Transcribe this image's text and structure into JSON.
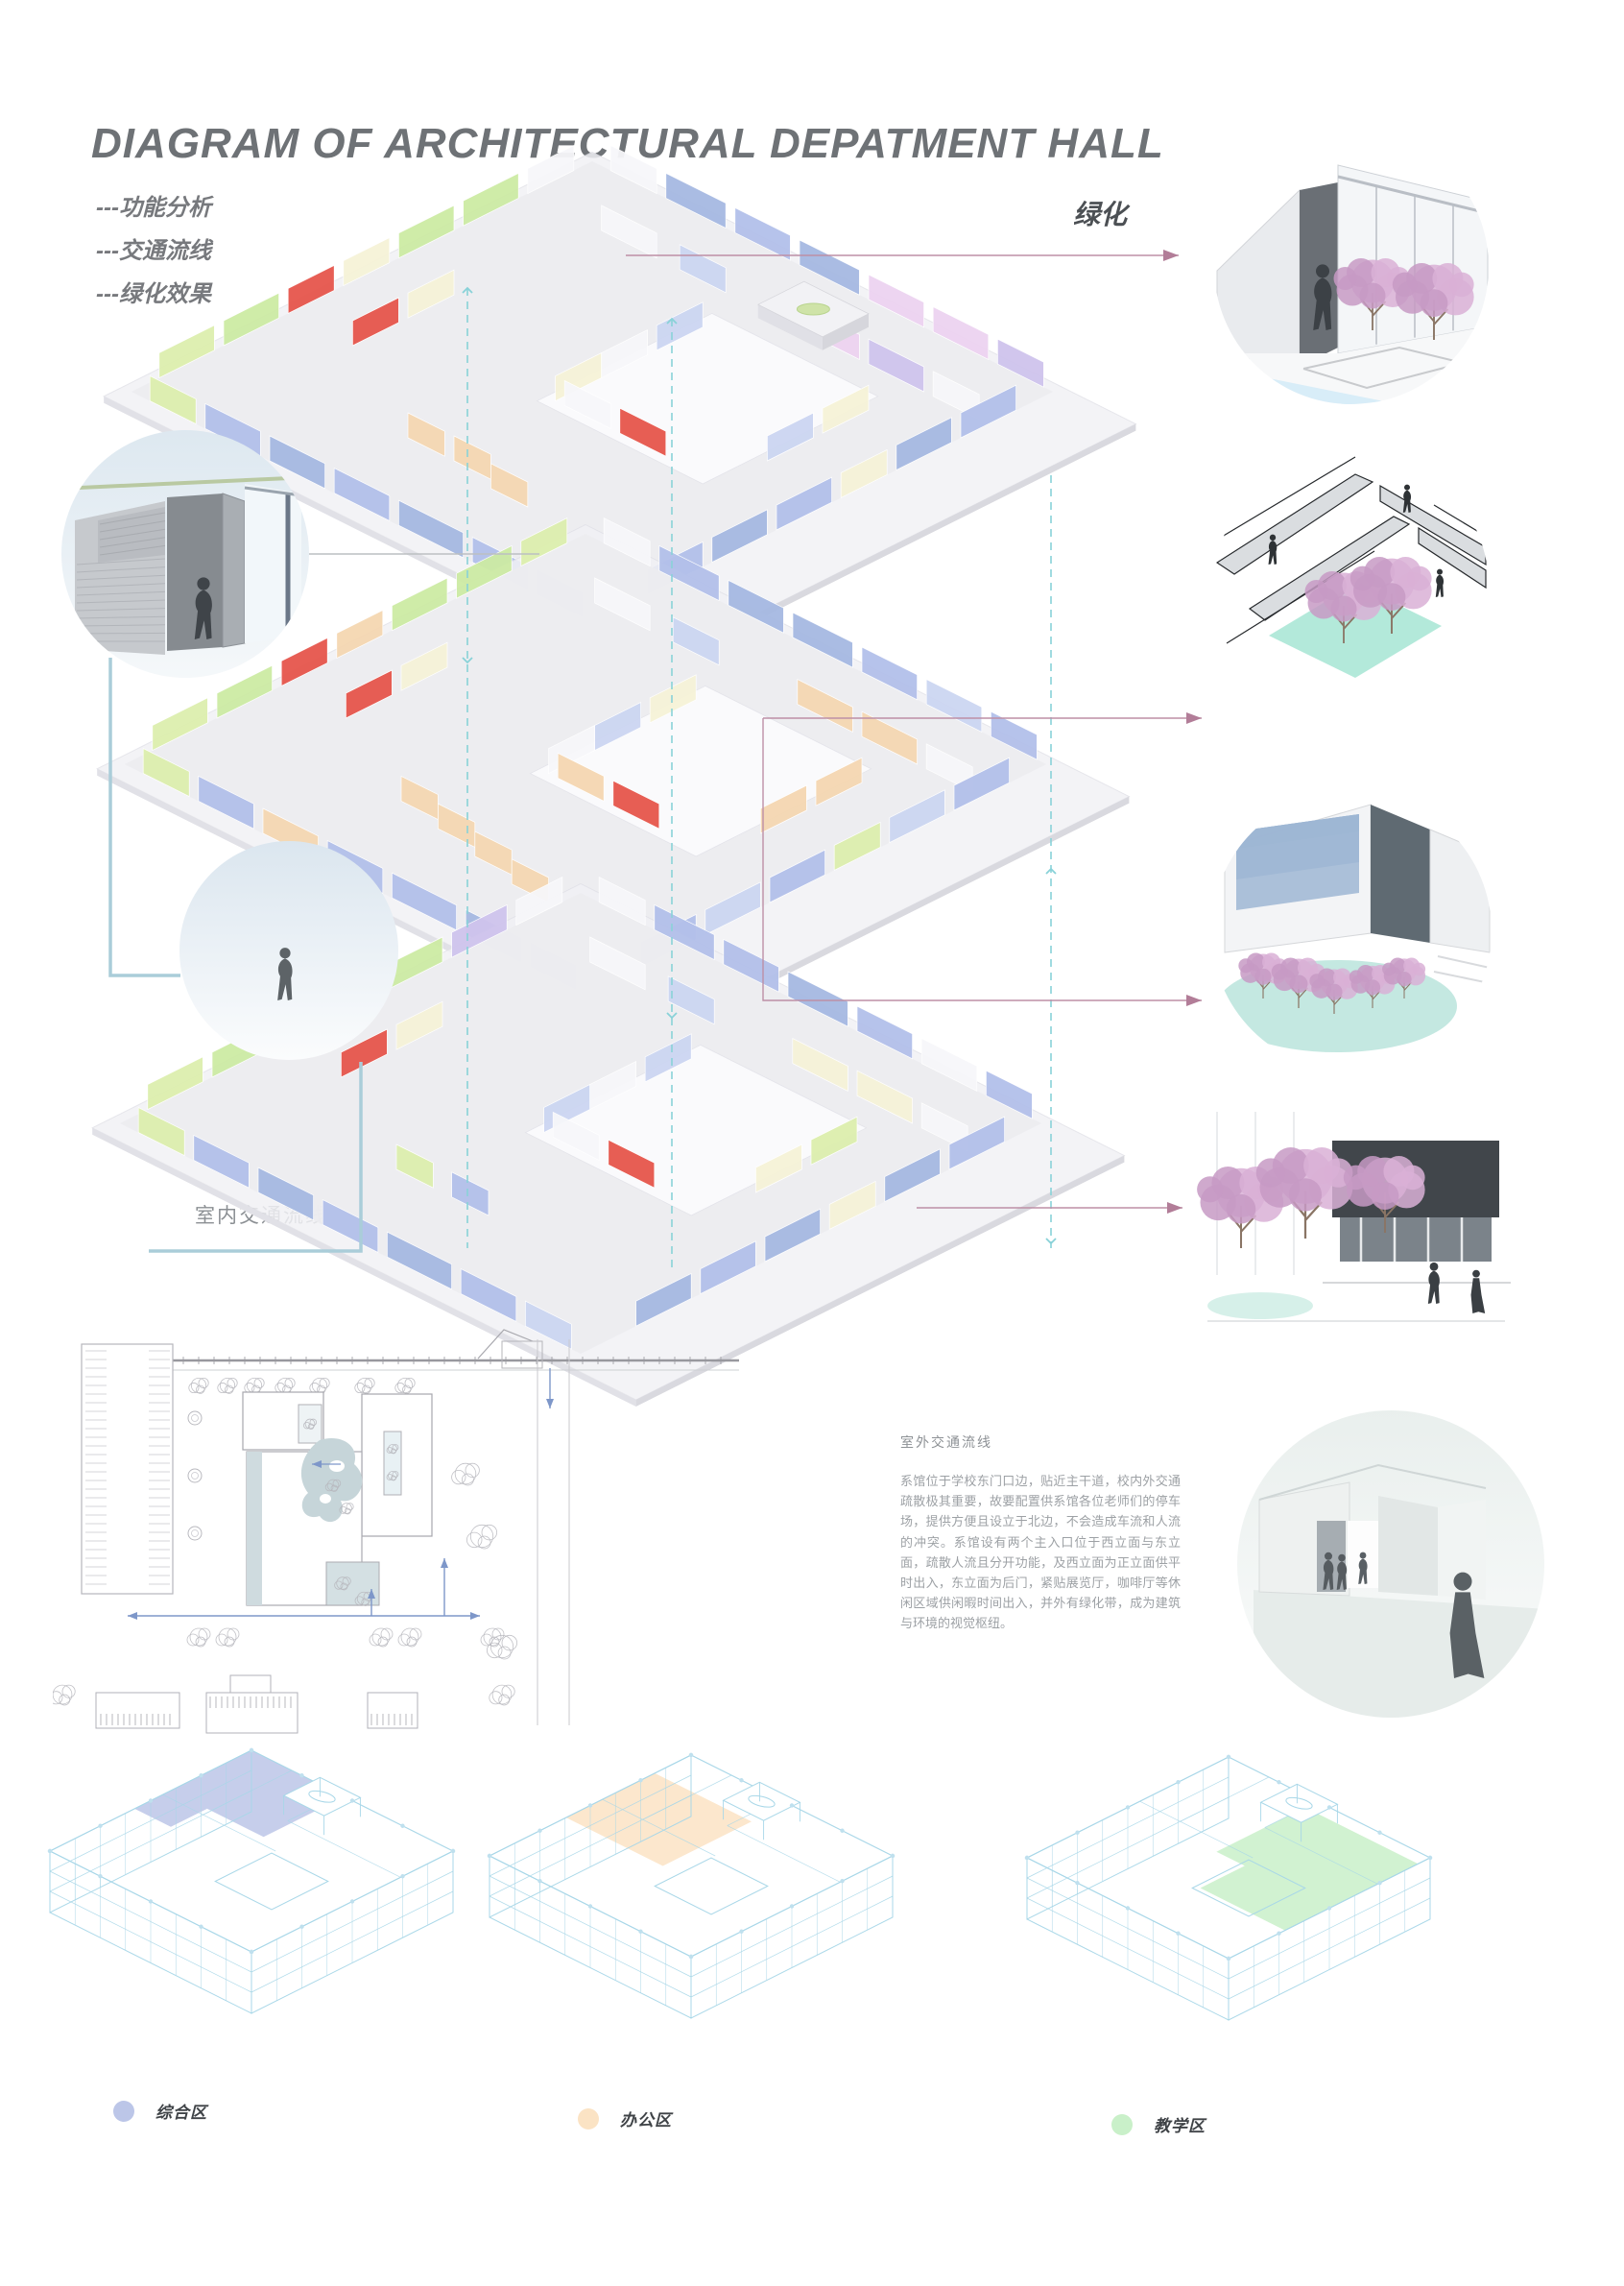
{
  "header": {
    "title": "DIAGRAM OF ARCHITECTURAL DEPATMENT HALL"
  },
  "analysis_legend": {
    "items": [
      {
        "label": "---功能分析"
      },
      {
        "label": "---交通流线"
      },
      {
        "label": "---绿化效果"
      }
    ]
  },
  "labels": {
    "greening": "绿化",
    "indoor_circulation": "室内交通流线"
  },
  "outdoor_text": {
    "heading": "室外交通流线",
    "body": "系馆位于学校东门口边，贴近主干道，校内外交通疏散极其重要，故要配置供系馆各位老师们的停车场，提供方便且设立于北边，不会造成车流和人流的冲突。系馆设有两个主入口位于西立面与东立面，疏散人流且分开功能，及西立面为正立面供平时出入，东立面为后门，紧贴展览厅，咖啡厅等休闲区域供闲暇时间出入，并外有绿化带，成为建筑与环境的视觉枢纽。"
  },
  "zone_legend": {
    "items": [
      {
        "label": "综合区",
        "color": "#bcc6e8"
      },
      {
        "label": "办公区",
        "color": "#fbe3c4"
      },
      {
        "label": "教学区",
        "color": "#c9f0c9"
      }
    ]
  },
  "colors": {
    "arrow_pink": "#bd8fa6",
    "dashed_teal": "#89d2d8",
    "connector_blue": "#aacdd9",
    "connector_gray": "#bcbfc2",
    "wireframe_blue": "#a8d7e8",
    "slab": "#efeff3",
    "water": "#d8edf8",
    "mint": "#abe7d6",
    "tree_pink_1": "#d9b0d6",
    "tree_pink_2": "#c79ac4",
    "tree_trunk": "#8a7565",
    "silhouette": "#3f4449",
    "walls": {
      "P": "#a6b9e2",
      "B": "#b3c0ea",
      "BL": "#ccd6f2",
      "G": "#cdeba4",
      "GL": "#ddefae",
      "CRM": "#f6f3d8",
      "RED": "#e6564c",
      "PK": "#edd3f1",
      "LAV": "#cfc4ed",
      "PCH": "#f5d7b2",
      "W": "#f7f7fa"
    }
  },
  "axon": {
    "floors": [
      {
        "segments": [
          [
            4,
            0,
            10,
            0,
            "W"
          ],
          [
            16,
            0,
            13,
            0,
            "P"
          ],
          [
            31,
            0,
            12,
            0,
            "B"
          ],
          [
            0,
            4,
            0,
            10,
            "W"
          ],
          [
            45,
            0,
            13,
            0,
            "P"
          ],
          [
            60,
            0,
            12,
            0,
            "PK"
          ],
          [
            74,
            0,
            12,
            0,
            "PK"
          ],
          [
            88,
            0,
            10,
            0,
            "LAV"
          ],
          [
            0,
            16,
            0,
            12,
            "G"
          ],
          [
            0,
            30,
            0,
            12,
            "G"
          ],
          [
            16,
            14,
            12,
            0,
            "W"
          ],
          [
            33,
            14,
            10,
            0,
            "BL"
          ],
          [
            60,
            14,
            12,
            0,
            "PK"
          ],
          [
            74,
            14,
            12,
            0,
            "LAV"
          ],
          [
            88,
            14,
            10,
            0,
            "W"
          ],
          [
            0,
            44,
            0,
            10,
            "CRM"
          ],
          [
            14,
            44,
            0,
            10,
            "CRM"
          ],
          [
            48,
            24,
            0,
            10,
            "BL"
          ],
          [
            84,
            24,
            0,
            10,
            "CRM"
          ],
          [
            0,
            56,
            0,
            10,
            "RED"
          ],
          [
            14,
            56,
            0,
            10,
            "RED"
          ],
          [
            48,
            36,
            0,
            10,
            "W"
          ],
          [
            84,
            36,
            0,
            10,
            "BL"
          ],
          [
            0,
            68,
            0,
            12,
            "G"
          ],
          [
            48,
            46,
            0,
            10,
            "CRM"
          ],
          [
            100,
            8,
            0,
            12,
            "B"
          ],
          [
            100,
            22,
            0,
            12,
            "P"
          ],
          [
            50,
            56,
            10,
            0,
            "W"
          ],
          [
            62,
            56,
            10,
            0,
            "RED"
          ],
          [
            100,
            36,
            0,
            10,
            "CRM"
          ],
          [
            0,
            82,
            0,
            12,
            "GL"
          ],
          [
            100,
            48,
            0,
            12,
            "B"
          ],
          [
            100,
            62,
            0,
            12,
            "P"
          ],
          [
            100,
            76,
            0,
            12,
            "B"
          ],
          [
            40,
            80,
            8,
            0,
            "PCH"
          ],
          [
            50,
            80,
            8,
            0,
            "PCH"
          ],
          [
            60,
            82,
            8,
            0,
            "PCH"
          ],
          [
            4,
            100,
            10,
            0,
            "GL"
          ],
          [
            16,
            100,
            12,
            0,
            "B"
          ],
          [
            30,
            100,
            12,
            0,
            "P"
          ],
          [
            44,
            100,
            12,
            0,
            "B"
          ],
          [
            58,
            100,
            14,
            0,
            "P"
          ],
          [
            74,
            100,
            12,
            0,
            "B"
          ],
          [
            88,
            100,
            10,
            0,
            "P"
          ]
        ]
      },
      {
        "segments": [
          [
            4,
            0,
            10,
            0,
            "W"
          ],
          [
            16,
            0,
            13,
            0,
            "B"
          ],
          [
            31,
            0,
            12,
            0,
            "P"
          ],
          [
            0,
            4,
            0,
            10,
            "GL"
          ],
          [
            45,
            0,
            13,
            0,
            "P"
          ],
          [
            60,
            0,
            12,
            0,
            "B"
          ],
          [
            74,
            0,
            12,
            0,
            "BL"
          ],
          [
            88,
            0,
            10,
            0,
            "B"
          ],
          [
            0,
            16,
            0,
            12,
            "G"
          ],
          [
            0,
            30,
            0,
            12,
            "G"
          ],
          [
            16,
            14,
            12,
            0,
            "W"
          ],
          [
            33,
            14,
            10,
            0,
            "BL"
          ],
          [
            60,
            14,
            12,
            0,
            "PCH"
          ],
          [
            74,
            14,
            12,
            0,
            "PCH"
          ],
          [
            88,
            14,
            10,
            0,
            "W"
          ],
          [
            0,
            44,
            0,
            10,
            "PCH"
          ],
          [
            14,
            44,
            0,
            10,
            "CRM"
          ],
          [
            48,
            24,
            0,
            10,
            "CRM"
          ],
          [
            84,
            24,
            0,
            10,
            "PCH"
          ],
          [
            0,
            56,
            0,
            10,
            "RED"
          ],
          [
            14,
            56,
            0,
            10,
            "RED"
          ],
          [
            48,
            36,
            0,
            10,
            "BL"
          ],
          [
            84,
            36,
            0,
            10,
            "PCH"
          ],
          [
            0,
            68,
            0,
            12,
            "G"
          ],
          [
            48,
            46,
            0,
            10,
            "W"
          ],
          [
            100,
            8,
            0,
            12,
            "B"
          ],
          [
            100,
            22,
            0,
            12,
            "BL"
          ],
          [
            50,
            56,
            10,
            0,
            "PCH"
          ],
          [
            62,
            56,
            10,
            0,
            "RED"
          ],
          [
            100,
            36,
            0,
            10,
            "GL"
          ],
          [
            0,
            82,
            0,
            12,
            "GL"
          ],
          [
            100,
            48,
            0,
            12,
            "B"
          ],
          [
            100,
            62,
            0,
            12,
            "BL"
          ],
          [
            100,
            76,
            0,
            12,
            "B"
          ],
          [
            38,
            78,
            8,
            0,
            "PCH"
          ],
          [
            48,
            80,
            8,
            0,
            "PCH"
          ],
          [
            58,
            82,
            8,
            0,
            "PCH"
          ],
          [
            68,
            84,
            8,
            0,
            "PCH"
          ],
          [
            4,
            100,
            10,
            0,
            "GL"
          ],
          [
            16,
            100,
            12,
            0,
            "B"
          ],
          [
            30,
            100,
            12,
            0,
            "PCH"
          ],
          [
            44,
            100,
            12,
            0,
            "B"
          ],
          [
            58,
            100,
            14,
            0,
            "B"
          ],
          [
            74,
            100,
            12,
            0,
            "P"
          ],
          [
            88,
            100,
            10,
            0,
            "B"
          ]
        ]
      },
      {
        "segments": [
          [
            4,
            0,
            10,
            0,
            "W"
          ],
          [
            16,
            0,
            13,
            0,
            "B"
          ],
          [
            31,
            0,
            12,
            0,
            "B"
          ],
          [
            0,
            4,
            0,
            10,
            "W"
          ],
          [
            45,
            0,
            13,
            0,
            "P"
          ],
          [
            60,
            0,
            12,
            0,
            "B"
          ],
          [
            74,
            0,
            12,
            0,
            "W"
          ],
          [
            88,
            0,
            10,
            0,
            "B"
          ],
          [
            0,
            16,
            0,
            12,
            "LAV"
          ],
          [
            0,
            30,
            0,
            12,
            "G"
          ],
          [
            16,
            14,
            12,
            0,
            "W"
          ],
          [
            33,
            14,
            10,
            0,
            "BL"
          ],
          [
            60,
            14,
            12,
            0,
            "CRM"
          ],
          [
            74,
            14,
            12,
            0,
            "CRM"
          ],
          [
            88,
            14,
            10,
            0,
            "W"
          ],
          [
            0,
            44,
            0,
            10,
            "W"
          ],
          [
            14,
            44,
            0,
            10,
            "CRM"
          ],
          [
            48,
            24,
            0,
            10,
            "BL"
          ],
          [
            84,
            24,
            0,
            10,
            "GL"
          ],
          [
            0,
            56,
            0,
            10,
            "RED"
          ],
          [
            14,
            56,
            0,
            10,
            "RED"
          ],
          [
            48,
            36,
            0,
            10,
            "W"
          ],
          [
            84,
            36,
            0,
            10,
            "CRM"
          ],
          [
            0,
            68,
            0,
            12,
            "G"
          ],
          [
            48,
            46,
            0,
            10,
            "BL"
          ],
          [
            100,
            8,
            0,
            12,
            "B"
          ],
          [
            100,
            22,
            0,
            12,
            "P"
          ],
          [
            50,
            56,
            10,
            0,
            "W"
          ],
          [
            62,
            56,
            10,
            0,
            "RED"
          ],
          [
            100,
            36,
            0,
            10,
            "CRM"
          ],
          [
            0,
            82,
            0,
            12,
            "GL"
          ],
          [
            100,
            48,
            0,
            12,
            "P"
          ],
          [
            100,
            62,
            0,
            12,
            "B"
          ],
          [
            100,
            76,
            0,
            12,
            "P"
          ],
          [
            40,
            80,
            8,
            0,
            "GL"
          ],
          [
            52,
            80,
            8,
            0,
            "B"
          ],
          [
            4,
            100,
            10,
            0,
            "GL"
          ],
          [
            16,
            100,
            12,
            0,
            "B"
          ],
          [
            30,
            100,
            12,
            0,
            "P"
          ],
          [
            44,
            100,
            12,
            0,
            "B"
          ],
          [
            58,
            100,
            14,
            0,
            "P"
          ],
          [
            74,
            100,
            12,
            0,
            "B"
          ],
          [
            88,
            100,
            10,
            0,
            "BL"
          ]
        ]
      }
    ]
  }
}
